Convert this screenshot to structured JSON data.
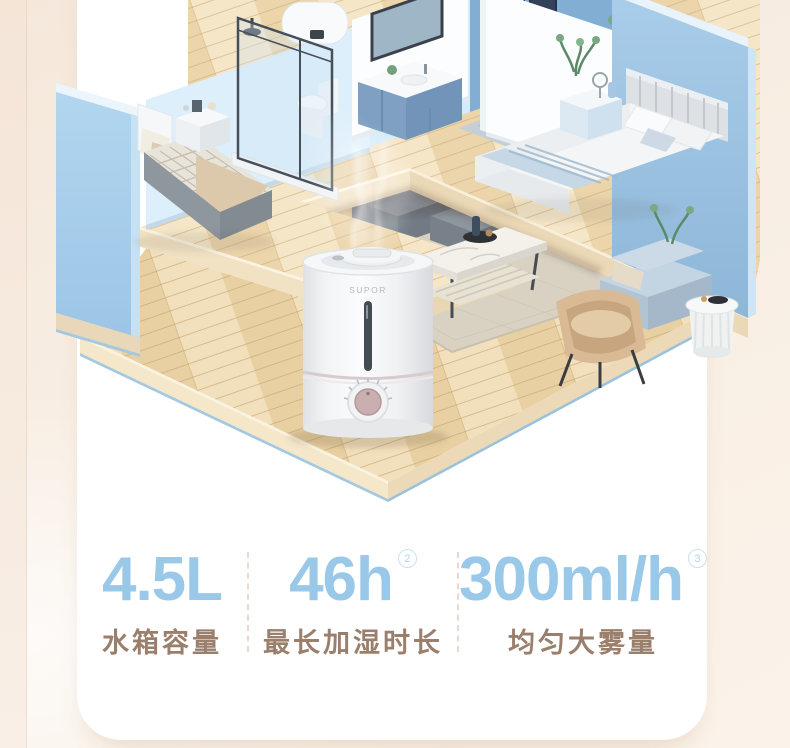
{
  "product": {
    "brand_logo": "SUPOR"
  },
  "illustration": {
    "type": "isometric-apartment-cutaway",
    "rooms": [
      "bedroom",
      "bathroom",
      "study",
      "master-bedroom",
      "living-room"
    ],
    "wall_blue": "#a6cdea",
    "accent_wall_blue": "#7fa4c4",
    "floor_wood": "#eed8ae",
    "mist_color": "#ffffff"
  },
  "stats": {
    "value_color": "#9ac8e8",
    "label_color": "#9b7f6d",
    "divider_color": "#e9d8cd",
    "items": [
      {
        "value": "4.5L",
        "superscript": "",
        "label": "水箱容量"
      },
      {
        "value": "46h",
        "superscript": "2",
        "label": "最长加湿时长"
      },
      {
        "value": "300ml/h",
        "superscript": "3",
        "label": "均匀大雾量"
      }
    ]
  }
}
